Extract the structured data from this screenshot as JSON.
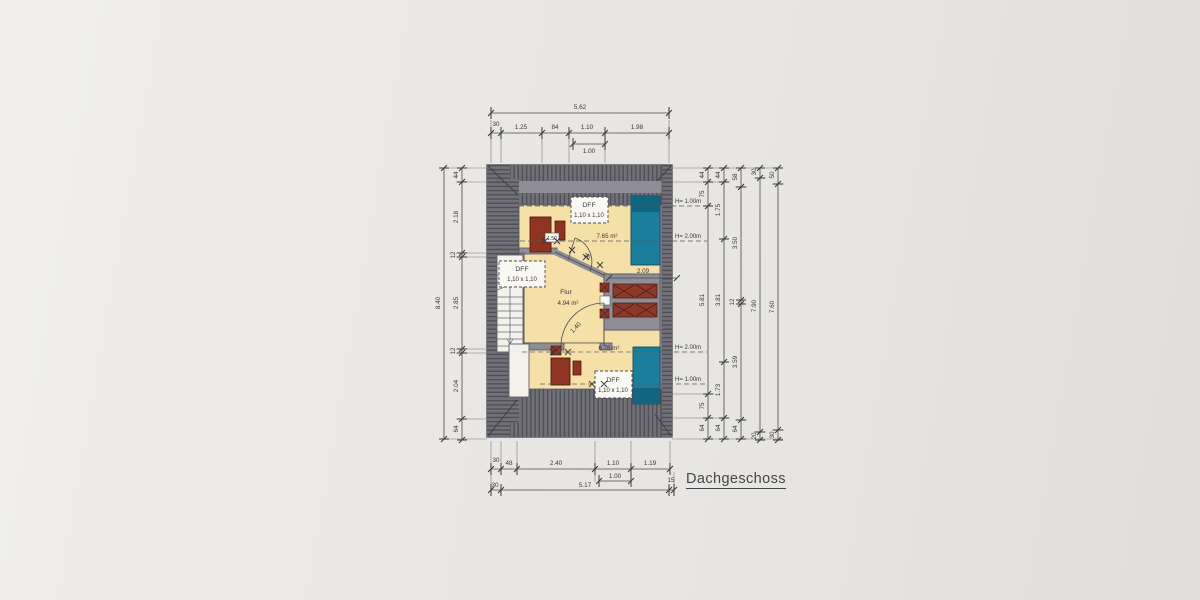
{
  "drawing": {
    "title": "Dachgeschoss"
  },
  "colors": {
    "paper": "#eae8e4",
    "roof_base": "#716f78",
    "roof_hatch_line": "#4d4c54",
    "wall_gray": "#8f8d97",
    "room_fill": "#f5e1a8",
    "teal": "#1c7e9d",
    "teal_dark": "#11657f",
    "red": "#8f3322",
    "ink": "#37363c"
  },
  "plan": {
    "rooms": {
      "flur": {
        "name": "Flur",
        "area": "4.94 m²"
      },
      "room_top": {
        "area": "7.65 m²"
      },
      "room_bottom": {
        "area": "6.78 m²"
      }
    },
    "roof_window": {
      "label": "DFF",
      "size": "1,10 x 1,10"
    },
    "annotations": {
      "chimney_width": "1.50",
      "shelf_width": "2.09",
      "door_top": "76",
      "door_bottom": "1.40"
    },
    "height_markers": {
      "top_outer": "H= 1.00m",
      "top_inner": "H= 2.00m",
      "bottom_inner": "H= 2.00m",
      "bottom_outer": "H= 1.00m"
    }
  },
  "dimensions": {
    "top": {
      "total": "5.62",
      "segments": [
        "30",
        "1.25",
        "84",
        "1.10",
        "1.98"
      ],
      "window": "1.00"
    },
    "bottom": {
      "segments": [
        "30",
        "48",
        "2.40",
        "1.10",
        "1.19"
      ],
      "window": "1.00",
      "row2": [
        "30",
        "5.17",
        "15"
      ]
    },
    "left": {
      "total": "8.40",
      "segments": [
        "44",
        "2.18",
        "12",
        "2.85",
        "12",
        "2.04",
        "64"
      ]
    },
    "right": {
      "chain1": [
        "44",
        "75",
        "5.81",
        "75",
        "64"
      ],
      "chain2": [
        "44",
        "1.75",
        "3.81",
        "1.73",
        "64"
      ],
      "chain3": [
        "58",
        "3.50",
        "12",
        "3.59",
        "64"
      ],
      "chain4": [
        "30",
        "7.90",
        "20"
      ],
      "chain5": [
        "50",
        "7.60",
        "30"
      ]
    }
  }
}
